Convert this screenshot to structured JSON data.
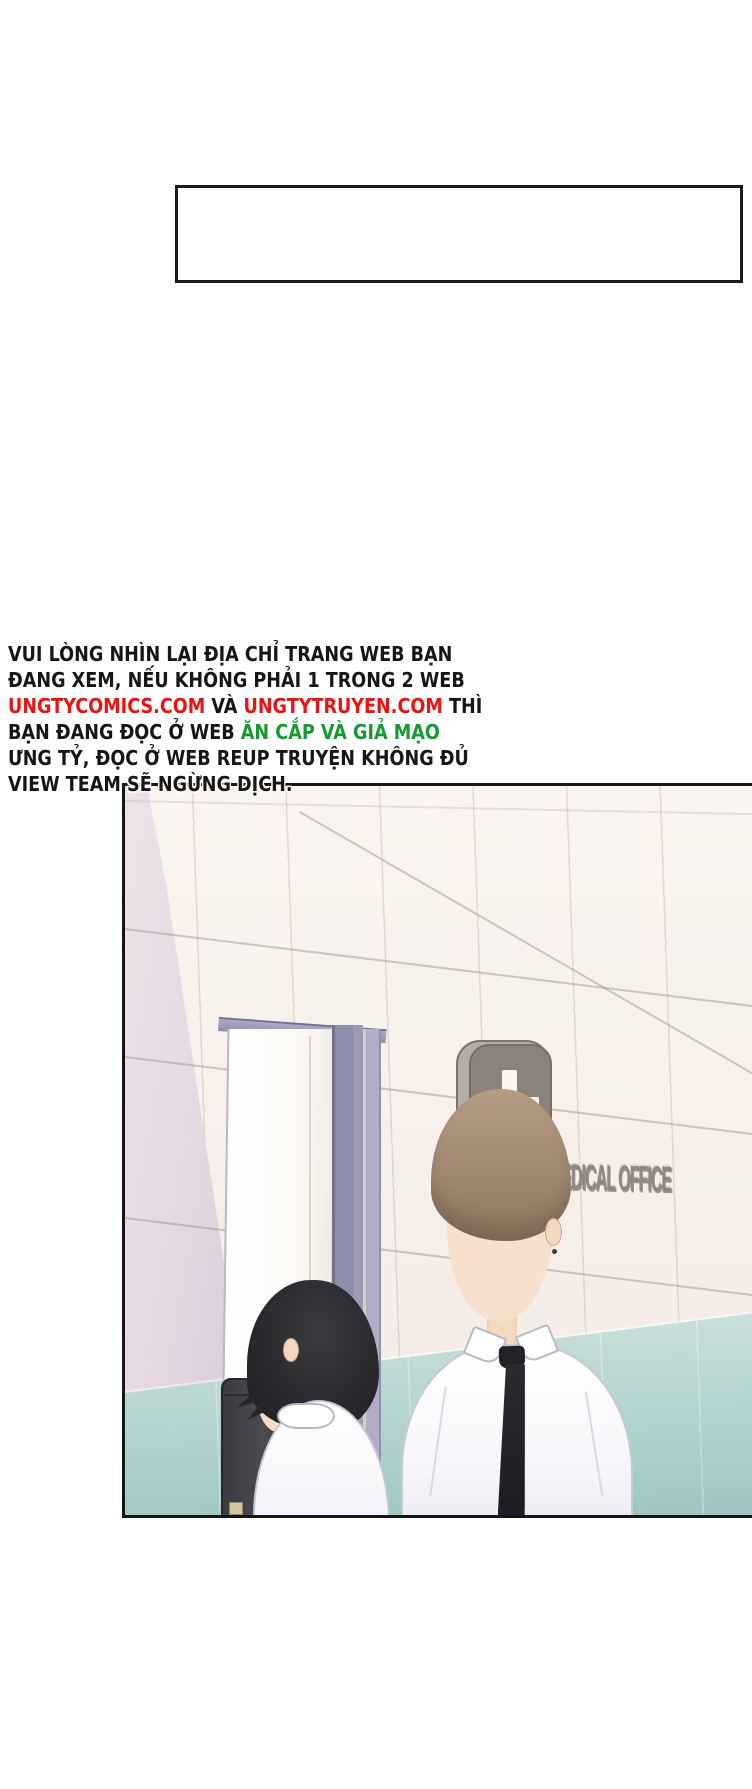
{
  "notice_box": {
    "content": ""
  },
  "warning": {
    "line1": "VUI LÒNG NHÌN LẠI ĐỊA CHỈ TRANG WEB BẠN",
    "line2": "ĐANG XEM, NẾU KHÔNG PHẢI 1 TRONG 2 WEB",
    "line3_link1": "UNGTYCOMICS.COM",
    "line3_mid": " VÀ ",
    "line3_link2": "UNGTYTRUYEN.COM",
    "line3_end": " THÌ",
    "line4_start": "BẠN ĐANG ĐỌC Ở WEB ",
    "line4_highlight": "ĂN CẮP VÀ GIẢ MẠO",
    "line5": "ƯNG TỶ, ĐỌC Ở WEB REUP TRUYỆN KHÔNG ĐỦ",
    "line6": "VIEW TEAM SẼ NGỪNG DỊCH.",
    "colors": {
      "text": "#161616",
      "link_red": "#ec1212",
      "highlight_green": "#149b30"
    }
  },
  "panel": {
    "sign_label": "MEDICAL OFFICE",
    "scene": "two students in white shirts outside a medical office door",
    "colors": {
      "wall": "#f7f1ea",
      "wainscot_teal": "#a7ccc9",
      "door_frame_purple": "#8f8dac",
      "left_wall_lavender": "#e4d7e1",
      "sign_gray": "#8b837b",
      "cross_white": "#faf6ef",
      "hair_left": "#2a2a2e",
      "hair_right": "#a18871",
      "tie_black": "#232327",
      "border": "#161616"
    }
  }
}
